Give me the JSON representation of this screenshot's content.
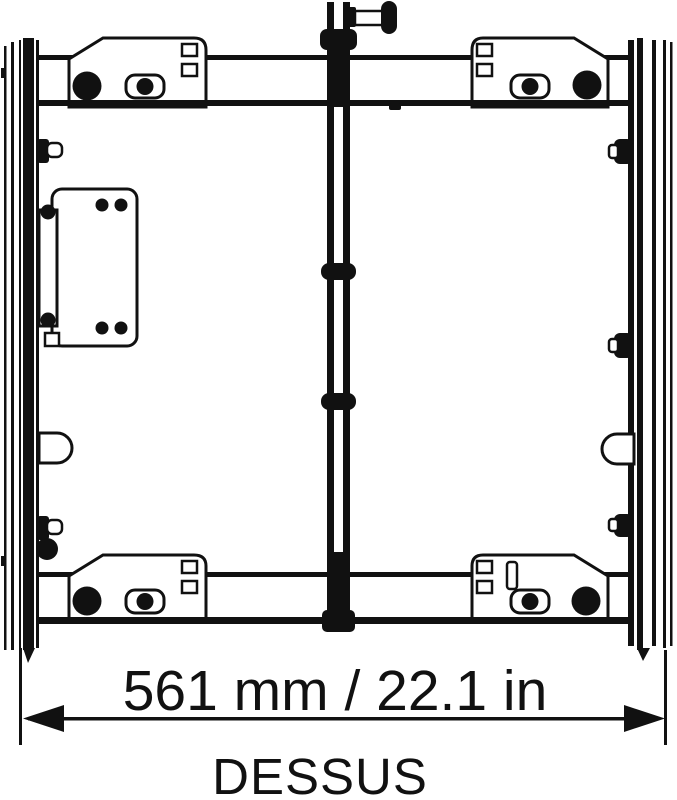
{
  "drawing": {
    "title": "enclosure-top-view-dimension-drawing",
    "view_label": "DESSUS",
    "dimension": {
      "label": "561 mm / 22.1 in",
      "value_mm": "561",
      "value_in": "22.1"
    },
    "colors": {
      "ink": "#111111",
      "background": "#ffffff"
    }
  }
}
